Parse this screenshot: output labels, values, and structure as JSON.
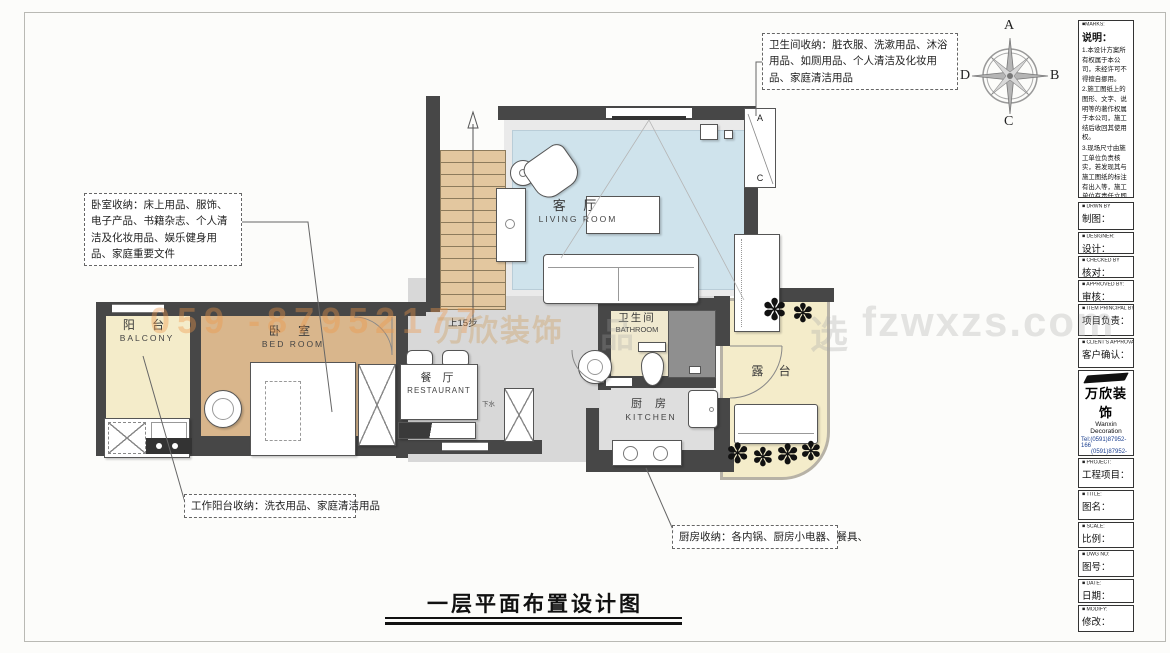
{
  "sheet_title": "一层平面布置设计图",
  "compass": {
    "n": "A",
    "e": "B",
    "s": "C",
    "w": "D"
  },
  "rooms": {
    "living": {
      "zh": "客 厅",
      "en": "LIVING  ROOM"
    },
    "bedroom": {
      "zh": "卧 室",
      "en": "BED  ROOM"
    },
    "balcony": {
      "zh": "阳 台",
      "en": "BALCONY"
    },
    "restaurant": {
      "zh": "餐 厅",
      "en": "RESTAURANT"
    },
    "bathroom": {
      "zh": "卫生间",
      "en": "BATHROOM"
    },
    "kitchen": {
      "zh": "厨 房",
      "en": "KITCHEN"
    },
    "terrace": {
      "zh": "露 台",
      "en": ""
    }
  },
  "labels": {
    "stairs_up": "上15步",
    "drain": "下水",
    "win_a": "A",
    "win_c": "C"
  },
  "annotations": {
    "bathroom": "卫生间收纳：脏衣服、洗漱用品、沐浴用品、如厕用品、个人清洁及化妆用品、家庭清洁用品",
    "bedroom": "卧室收纳：床上用品、服饰、电子产品、书籍杂志、个人清洁及化妆用品、娱乐健身用品、家庭重要文件",
    "balcony": "工作阳台收纳：洗衣用品、家庭清洁用品",
    "kitchen": "厨房收纳：各内锅、厨房小电器、餐具、"
  },
  "watermarks": {
    "left": "059 -87952177",
    "center": "万欣装饰",
    "pin": "品",
    "xuan": "选",
    "site": "fzwxzs.com"
  },
  "titleblock": {
    "marks_en": "■MARKS:",
    "marks_zh": "说明：",
    "notes": [
      "1.本设计方案所有权属于本公司，未经许可不得擅自挪用。",
      "2.施工图纸上的图形、文字、说明等的著作权属于本公司，施工结后收回其使用权。",
      "3.现场尺寸由施工单位负责核实，若发现其与施工图纸的标注有出入等，施工单位有责任立即通知本公司，否则施工单位须承担所有责任。",
      "4.本设计方案是按客户要求设计，经客户签字即视为同意认可，不得随意更改。"
    ],
    "rows": [
      {
        "en": "■ DRWN BY",
        "zh": "制图："
      },
      {
        "en": "■ DESIGNER:",
        "zh": "设计："
      },
      {
        "en": "■ CHECKED BY",
        "zh": "核对："
      },
      {
        "en": "■ APPROVED BY:",
        "zh": "审核："
      },
      {
        "en": "■ ITEM PRINCIPAL BY:",
        "zh": "项目负责："
      },
      {
        "en": "■ CLIENT'S APPROVAL:",
        "zh": "客户确认："
      }
    ],
    "company": {
      "logo": "万欣装饰",
      "name_en": "Wanxin Decoration",
      "tel1": "Tel:(0591)87952-166",
      "tel2": "(0591)87952-177",
      "fax": "Fax:(0591)87952-199",
      "web": "Web:WWW.fzwxzs.com"
    },
    "rows2": [
      {
        "en": "■ PROJECT:",
        "zh": "工程项目："
      },
      {
        "en": "■ TITLE:",
        "zh": "图名："
      },
      {
        "en": "■ SCALE:",
        "zh": "比例："
      },
      {
        "en": "■ DWG NO:",
        "zh": "图号："
      },
      {
        "en": "■ DATE:",
        "zh": "日期："
      },
      {
        "en": "■ MODIFY:",
        "zh": "修改："
      }
    ]
  },
  "icons": {
    "plant": "✽"
  },
  "colors": {
    "wall": "#474747",
    "rug_blue": "#cfe3ec",
    "bedroom_floor": "#d9b68c",
    "cream_floor": "#f4ecca",
    "hall_gray": "#d8d8d8",
    "stair_wood": "#e3c79f",
    "watermark_orange": "#f09646",
    "contact_blue": "#1b3f8f"
  }
}
